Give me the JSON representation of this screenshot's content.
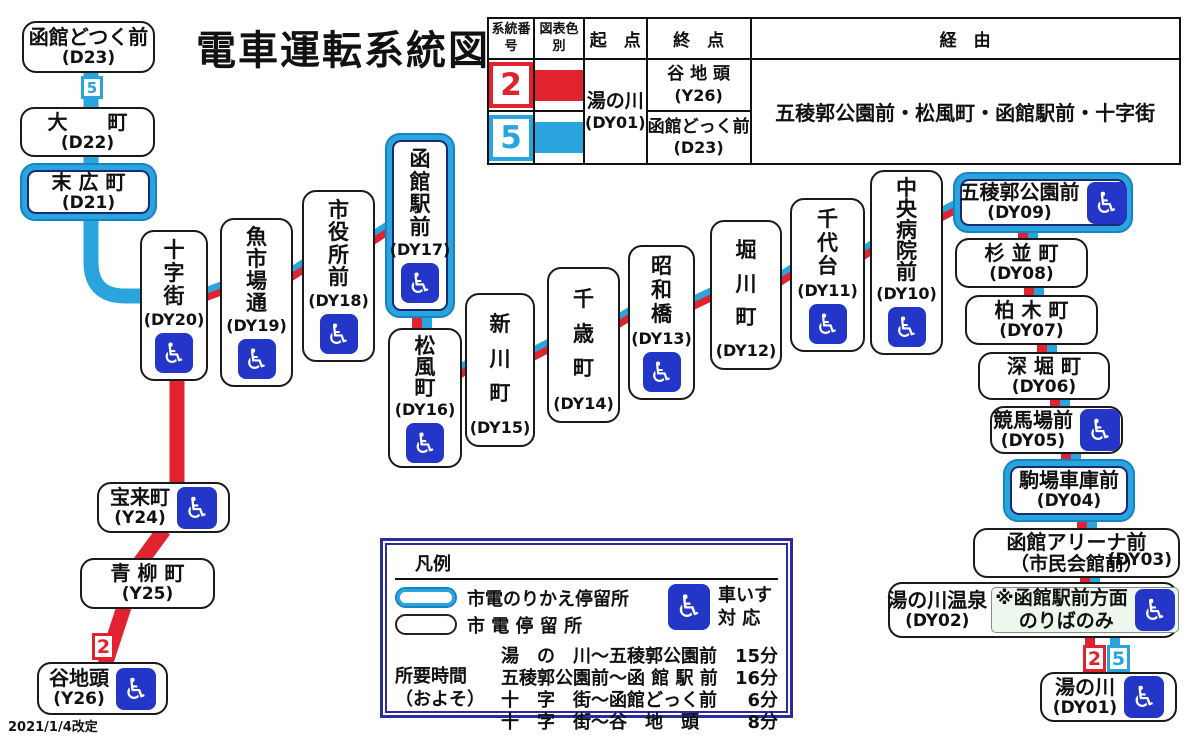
{
  "title": "電車運転系統図",
  "revision_note": "2021/1/4改定",
  "colors": {
    "route2_red": "#e0232e",
    "route5_blue": "#2aa4dc",
    "wheelchair_blue": "#2336c8",
    "interchange_border": "#1583c5",
    "legend_border_navy": "#2b2d9e"
  },
  "route_table": {
    "col_headers": [
      "系統番号",
      "図表色別",
      "起　点",
      "終　点",
      "経　由"
    ],
    "origin": "湯の川",
    "origin_code": "(DY01)",
    "via": "五稜郭公園前・松風町・函館駅前・十字街",
    "rows": [
      {
        "route_no": "2",
        "color": "#e0232e",
        "terminus": "谷 地 頭",
        "terminus_code": "(Y26)"
      },
      {
        "route_no": "5",
        "color": "#2aa4dc",
        "terminus": "函館どっく前",
        "terminus_code": "(D23)"
      }
    ]
  },
  "legend": {
    "title": "凡例",
    "transfer_stop": "市電のりかえ停留所",
    "regular_stop": "市 電 停 留 所",
    "wheelchair_label_1": "車いす",
    "wheelchair_label_2": "対 応",
    "duration_label_1": "所要時間",
    "duration_label_2": "（およそ）",
    "durations": [
      {
        "section": "湯　の　川～五稜郭公園前",
        "time": "15分"
      },
      {
        "section": "五稜郭公園前～函 館 駅 前",
        "time": "16分"
      },
      {
        "section": "十　字　街～函館どっく前",
        "time": "6分"
      },
      {
        "section": "十　字　街～谷　地　頭",
        "time": "8分"
      }
    ]
  },
  "stations": [
    {
      "id": "hakodate-dokku-mae",
      "name": "函館どつく前",
      "code": "(D23)",
      "x": 22,
      "y": 21,
      "w": 133,
      "h": 52,
      "orient": "h",
      "wc": false,
      "xc": false
    },
    {
      "id": "omachi",
      "name": "大　　町",
      "code": "(D22)",
      "x": 20,
      "y": 107,
      "w": 135,
      "h": 50,
      "orient": "h",
      "wc": false,
      "xc": false
    },
    {
      "id": "suehirocho",
      "name": "末 広 町",
      "code": "(D21)",
      "x": 20,
      "y": 163,
      "w": 137,
      "h": 58,
      "orient": "h",
      "wc": false,
      "xc": true
    },
    {
      "id": "jujigai",
      "name": "十字街",
      "code": "(DY20)",
      "x": 140,
      "y": 230,
      "w": 68,
      "h": 151,
      "orient": "v",
      "wc": true,
      "xc": false
    },
    {
      "id": "uoichiba-dori",
      "name": "魚市場通",
      "code": "(DY19)",
      "x": 220,
      "y": 218,
      "w": 73,
      "h": 169,
      "orient": "v",
      "wc": true,
      "xc": false
    },
    {
      "id": "shiyakusho-mae",
      "name": "市役所前",
      "code": "(DY18)",
      "x": 302,
      "y": 190,
      "w": 73,
      "h": 172,
      "orient": "v",
      "wc": true,
      "xc": false
    },
    {
      "id": "hakodate-ekimae",
      "name": "函館駅前",
      "code": "(DY17)",
      "x": 385,
      "y": 133,
      "w": 70,
      "h": 185,
      "orient": "v",
      "wc": true,
      "xc": true
    },
    {
      "id": "matsukazecho",
      "name": "松風町",
      "code": "(DY16)",
      "x": 388,
      "y": 328,
      "w": 74,
      "h": 140,
      "orient": "v",
      "wc": true,
      "xc": false
    },
    {
      "id": "shinkawacho",
      "name": "新川町",
      "code": "(DY15)",
      "x": 465,
      "y": 293,
      "w": 70,
      "h": 154,
      "orient": "v",
      "wc": false,
      "xc": false
    },
    {
      "id": "chitosecho",
      "name": "千歳町",
      "code": "(DY14)",
      "x": 547,
      "y": 267,
      "w": 73,
      "h": 156,
      "orient": "v",
      "wc": false,
      "xc": false
    },
    {
      "id": "showabashi",
      "name": "昭和橋",
      "code": "(DY13)",
      "x": 628,
      "y": 245,
      "w": 67,
      "h": 155,
      "orient": "v",
      "wc": true,
      "xc": false
    },
    {
      "id": "horikawacho",
      "name": "堀川町",
      "code": "(DY12)",
      "x": 710,
      "y": 220,
      "w": 72,
      "h": 150,
      "orient": "v",
      "wc": false,
      "xc": false
    },
    {
      "id": "chiyogadai",
      "name": "千代台",
      "code": "(DY11)",
      "x": 790,
      "y": 198,
      "w": 75,
      "h": 154,
      "orient": "v",
      "wc": true,
      "xc": false
    },
    {
      "id": "chuo-byoin-mae",
      "name": "中央病院前",
      "code": "(DY10)",
      "x": 870,
      "y": 170,
      "w": 73,
      "h": 185,
      "orient": "v",
      "wc": true,
      "xc": false
    },
    {
      "id": "goryokaku-koen-mae",
      "name": "五稜郭公園前",
      "code": "(DY09)",
      "x": 953,
      "y": 172,
      "w": 180,
      "h": 61,
      "orient": "h",
      "wc": true,
      "xc": true
    },
    {
      "id": "suginamicho",
      "name": "杉 並 町",
      "code": "(DY08)",
      "x": 955,
      "y": 238,
      "w": 133,
      "h": 50,
      "orient": "h",
      "wc": false,
      "xc": false
    },
    {
      "id": "kashiwagicho",
      "name": "柏 木 町",
      "code": "(DY07)",
      "x": 965,
      "y": 295,
      "w": 133,
      "h": 50,
      "orient": "h",
      "wc": false,
      "xc": false
    },
    {
      "id": "fukaboricho",
      "name": "深 堀 町",
      "code": "(DY06)",
      "x": 978,
      "y": 352,
      "w": 132,
      "h": 48,
      "orient": "h",
      "wc": false,
      "xc": false
    },
    {
      "id": "keibajo-mae",
      "name": "競馬場前",
      "code": "(DY05)",
      "x": 990,
      "y": 406,
      "w": 133,
      "h": 48,
      "orient": "h",
      "wc": true,
      "xc": false
    },
    {
      "id": "komaba-shako-mae",
      "name": "駒場車庫前",
      "code": "(DY04)",
      "x": 1003,
      "y": 459,
      "w": 132,
      "h": 63,
      "orient": "h",
      "wc": false,
      "xc": true
    },
    {
      "id": "hakodate-arena-mae",
      "name": "函館アリーナ前",
      "name2": "（市民会館前）",
      "code": "(DY03)",
      "x": 973,
      "y": 528,
      "w": 207,
      "h": 50,
      "orient": "h",
      "wc": false,
      "xc": false,
      "code_side": true
    },
    {
      "id": "yunokawa-onsen",
      "name": "湯の川温泉",
      "code": "(DY02)",
      "x": 888,
      "y": 582,
      "w": 290,
      "h": 56,
      "orient": "h",
      "wc": true,
      "xc": false,
      "note1": "※函館駅前方面",
      "note2": "のりばのみ"
    },
    {
      "id": "yunokawa",
      "name": "湯の川",
      "code": "(DY01)",
      "x": 1040,
      "y": 672,
      "w": 137,
      "h": 50,
      "orient": "h",
      "wc": true,
      "xc": false
    },
    {
      "id": "horaicho",
      "name": "宝来町",
      "code": "(Y24)",
      "x": 97,
      "y": 482,
      "w": 133,
      "h": 51,
      "orient": "h",
      "wc": true,
      "xc": false
    },
    {
      "id": "aoyagicho",
      "name": "青 柳 町",
      "code": "(Y25)",
      "x": 80,
      "y": 558,
      "w": 135,
      "h": 51,
      "orient": "h",
      "wc": false,
      "xc": false
    },
    {
      "id": "yachigashira",
      "name": "谷地頭",
      "code": "(Y26)",
      "x": 37,
      "y": 662,
      "w": 131,
      "h": 53,
      "orient": "h",
      "wc": true,
      "xc": false
    }
  ],
  "badges": [
    {
      "label": "5",
      "color": "blue",
      "x": 81,
      "y": 76,
      "w": 22,
      "h": 23
    },
    {
      "label": "2",
      "color": "red",
      "x": 92,
      "y": 633,
      "w": 23,
      "h": 27
    },
    {
      "label": "2",
      "color": "red",
      "x": 1083,
      "y": 645,
      "w": 23,
      "h": 27
    },
    {
      "label": "5",
      "color": "blue",
      "x": 1107,
      "y": 645,
      "w": 23,
      "h": 27
    }
  ],
  "wheelchair_glyph": "♿"
}
